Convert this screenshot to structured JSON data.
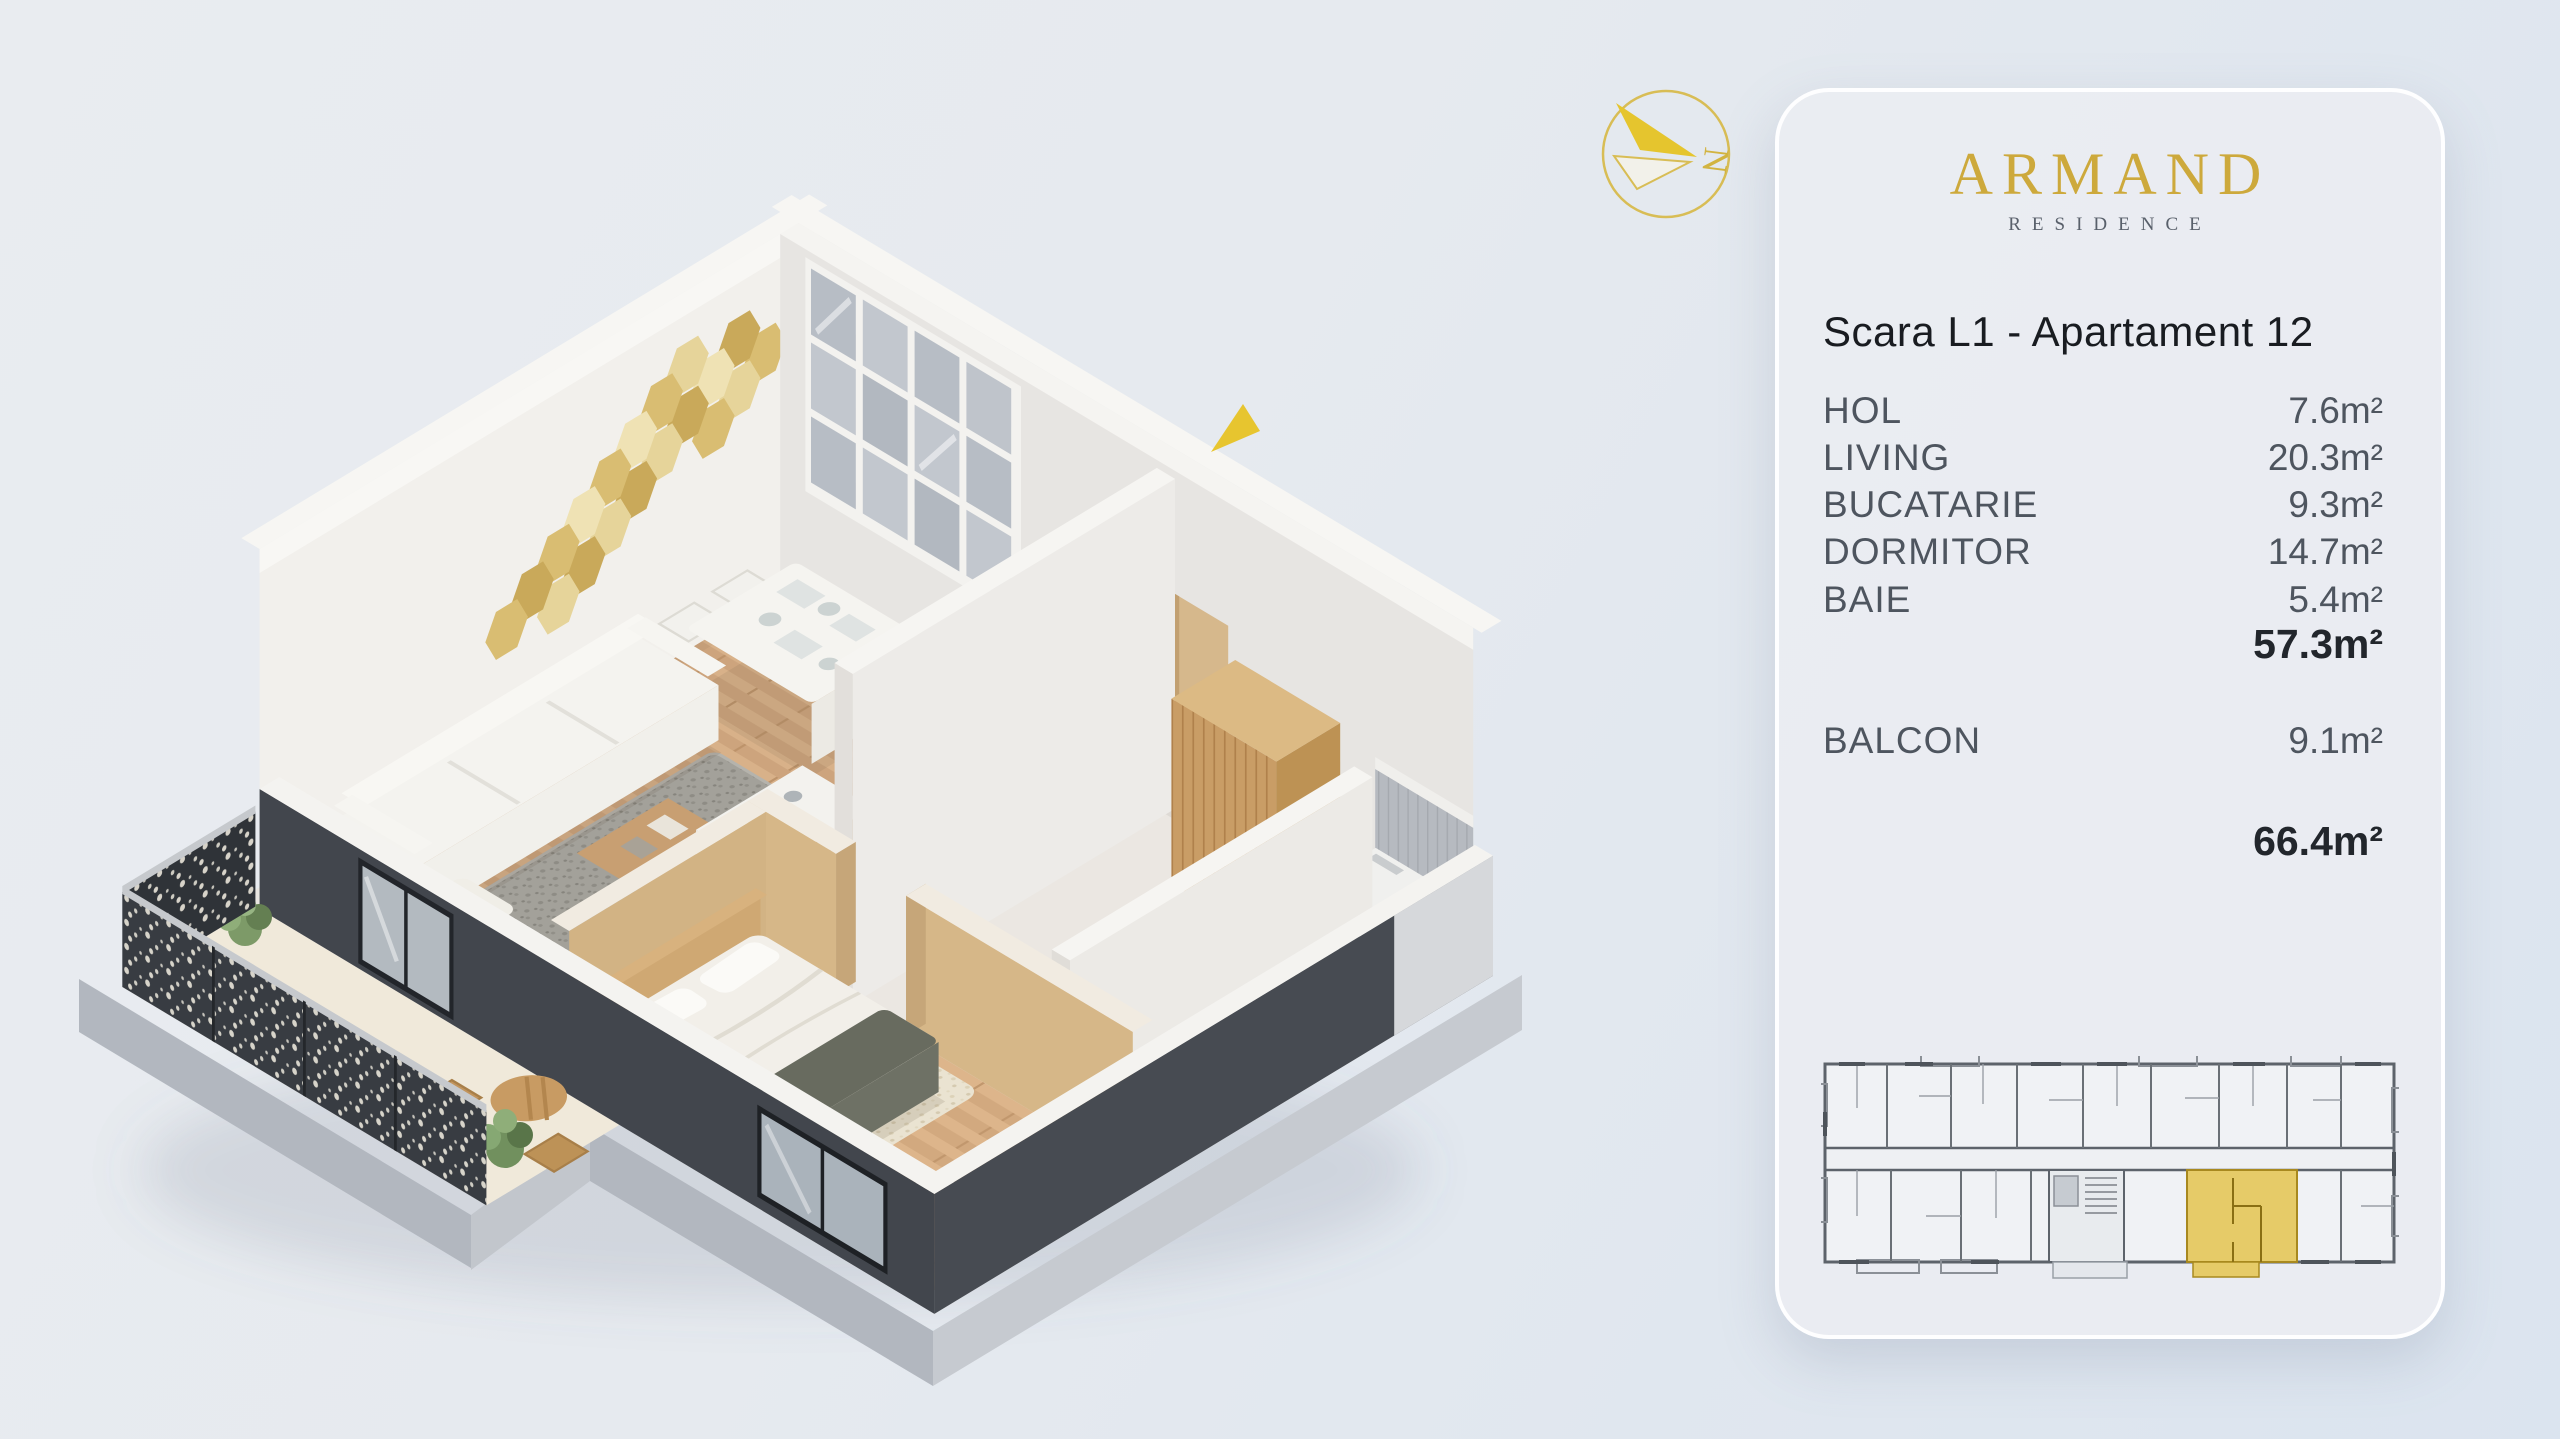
{
  "page": {
    "bg_top": "#e9ecf0",
    "bg_bottom": "#dbe4ef"
  },
  "compass": {
    "letter": "N"
  },
  "colors": {
    "accent_gold": "#cda93c",
    "highlight": "#e6cb68",
    "highlight_wall": "#a8891f",
    "marker": "#e7c52f",
    "railing": "#383c42",
    "dark_wall": "#42464d",
    "wood_floor": "#cda47d"
  },
  "card": {
    "brand": "ARMAND",
    "brand_subtitle": "RESIDENCE",
    "title": "Scara L1 - Apartament 12",
    "rooms": [
      {
        "name": "HOL",
        "area": "7.6m²"
      },
      {
        "name": "LIVING",
        "area": "20.3m²"
      },
      {
        "name": "BUCATARIE",
        "area": "9.3m²"
      },
      {
        "name": "DORMITOR",
        "area": "14.7m²"
      },
      {
        "name": "BAIE",
        "area": "5.4m²"
      }
    ],
    "subtotal": "57.3m²",
    "balcony": {
      "name": "BALCON",
      "area": "9.1m²"
    },
    "total": "66.4m²"
  }
}
